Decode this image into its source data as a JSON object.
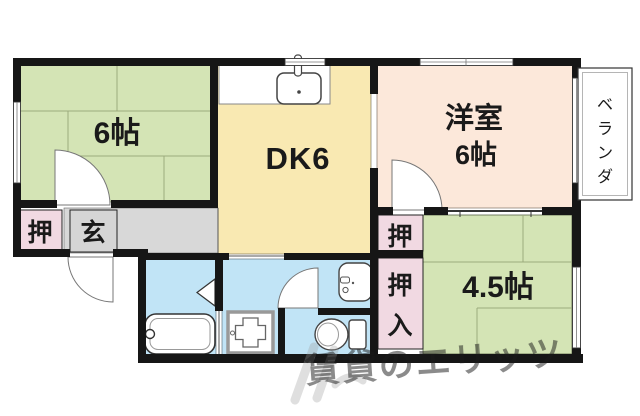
{
  "floor_plan": {
    "type": "apartment-floor-plan",
    "wall_color": "#161616",
    "rooms": {
      "tatami_6": {
        "label": "6帖",
        "color": "#d4e4b5"
      },
      "dk": {
        "label": "DK6",
        "color": "#f9e9b2"
      },
      "western_room": {
        "name_line": "洋室",
        "size_line": "6帖",
        "color": "#fce8da"
      },
      "tatami_4_5": {
        "label": "4.5帖",
        "color": "#d4e4b5"
      },
      "entrance": {
        "label": "玄",
        "color": "#d5d5d5"
      },
      "closet_entry": {
        "label": "押",
        "color": "#f1d9e2"
      },
      "closet_upper": {
        "label": "押",
        "color": "#f1d9e2"
      },
      "closet_lower": {
        "chars": [
          "押",
          "入"
        ],
        "color": "#f1d9e2"
      },
      "veranda": {
        "chars": [
          "ベ",
          "ラ",
          "ン",
          "ダ"
        ],
        "color": "#ffffff"
      },
      "wet_area_color": "#c1e4f6"
    },
    "fixtures": {
      "kitchen_sink_icon": "kitchen-sink",
      "bathtub_icon": "bathtub",
      "washing_machine_pan_icon": "washing-machine-pan",
      "toilet_icon": "toilet",
      "washbasin_icon": "washbasin"
    },
    "watermark": {
      "text": "賃貸のエリッツ",
      "color": "#9e9e9e"
    }
  }
}
